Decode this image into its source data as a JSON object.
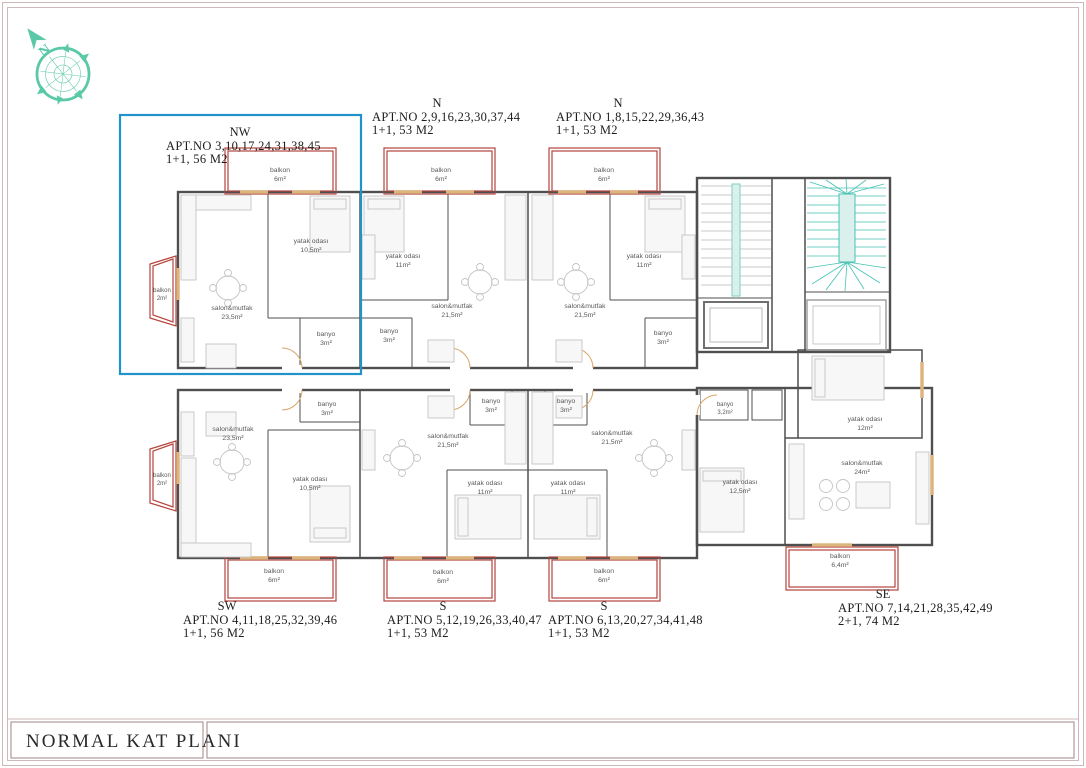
{
  "bottom_bar": {
    "title": "NORMAL KAT PLANI"
  },
  "compass": {
    "north_label": "N"
  },
  "colors": {
    "accent_blue": "#2293c8",
    "balcony_red": "#b5443c",
    "stair_teal": "#45c2b2",
    "compass_teal": "#5bc9a8",
    "wall_gray": "#4f4f4f",
    "window_tan": "#dcb57e"
  },
  "apartments": [
    {
      "direction": "NW",
      "apt_no": "APT.NO 3,10,17,24,31,38,45",
      "type_size": "1+1, 56 M2",
      "highlighted": true
    },
    {
      "direction": "N",
      "apt_no": "APT.NO 2,9,16,23,30,37,44",
      "type_size": "1+1, 53 M2",
      "highlighted": false
    },
    {
      "direction": "N",
      "apt_no": "APT.NO 1,8,15,22,29,36,43",
      "type_size": "1+1, 53 M2",
      "highlighted": false
    },
    {
      "direction": "SW",
      "apt_no": "APT.NO 4,11,18,25,32,39,46",
      "type_size": "1+1, 56 M2",
      "highlighted": false
    },
    {
      "direction": "S",
      "apt_no": "APT.NO 5,12,19,26,33,40,47",
      "type_size": "1+1, 53 M2",
      "highlighted": false
    },
    {
      "direction": "S",
      "apt_no": "APT.NO 6,13,20,27,34,41,48",
      "type_size": "1+1, 53 M2",
      "highlighted": false
    },
    {
      "direction": "SE",
      "apt_no": "APT.NO 7,14,21,28,35,42,49",
      "type_size": "2+1, 74 M2",
      "highlighted": false
    }
  ],
  "rooms": [
    {
      "apt": "NW",
      "name": "balkon",
      "area": "6m²"
    },
    {
      "apt": "NW",
      "name": "yatak odası",
      "area": "10,5m²"
    },
    {
      "apt": "NW",
      "name": "salon&mutfak",
      "area": "23,5m²"
    },
    {
      "apt": "NW",
      "name": "banyo",
      "area": "3m²"
    },
    {
      "apt": "NW",
      "name": "balkon",
      "area": "2m²"
    },
    {
      "apt": "N1",
      "name": "balkon",
      "area": "6m²"
    },
    {
      "apt": "N1",
      "name": "yatak odası",
      "area": "11m²"
    },
    {
      "apt": "N1",
      "name": "salon&mutfak",
      "area": "21,5m²"
    },
    {
      "apt": "N1",
      "name": "banyo",
      "area": "3m²"
    },
    {
      "apt": "N2",
      "name": "balkon",
      "area": "6m²"
    },
    {
      "apt": "N2",
      "name": "yatak odası",
      "area": "11m²"
    },
    {
      "apt": "N2",
      "name": "salon&mutfak",
      "area": "21,5m²"
    },
    {
      "apt": "N2",
      "name": "banyo",
      "area": "3m²"
    },
    {
      "apt": "SW",
      "name": "banyo",
      "area": "3m²"
    },
    {
      "apt": "SW",
      "name": "salon&mutfak",
      "area": "23,5m²"
    },
    {
      "apt": "SW",
      "name": "yatak odası",
      "area": "10,5m²"
    },
    {
      "apt": "SW",
      "name": "balkon",
      "area": "6m²"
    },
    {
      "apt": "SW",
      "name": "balkon",
      "area": "2m²"
    },
    {
      "apt": "S1",
      "name": "banyo",
      "area": "3m²"
    },
    {
      "apt": "S1",
      "name": "salon&mutfak",
      "area": "21,5m²"
    },
    {
      "apt": "S1",
      "name": "yatak odası",
      "area": "11m²"
    },
    {
      "apt": "S1",
      "name": "balkon",
      "area": "6m²"
    },
    {
      "apt": "S2",
      "name": "banyo",
      "area": "3m²"
    },
    {
      "apt": "S2",
      "name": "salon&mutfak",
      "area": "21,5m²"
    },
    {
      "apt": "S2",
      "name": "yatak odası",
      "area": "11m²"
    },
    {
      "apt": "S2",
      "name": "balkon",
      "area": "6m²"
    },
    {
      "apt": "SE",
      "name": "banyo",
      "area": "3,2m²"
    },
    {
      "apt": "SE",
      "name": "yatak odası",
      "area": "12,5m²"
    },
    {
      "apt": "SE",
      "name": "yatak odası",
      "area": "12m²"
    },
    {
      "apt": "SE",
      "name": "salon&mutfak",
      "area": "24m²"
    },
    {
      "apt": "SE",
      "name": "balkon",
      "area": "6,4m²"
    }
  ]
}
